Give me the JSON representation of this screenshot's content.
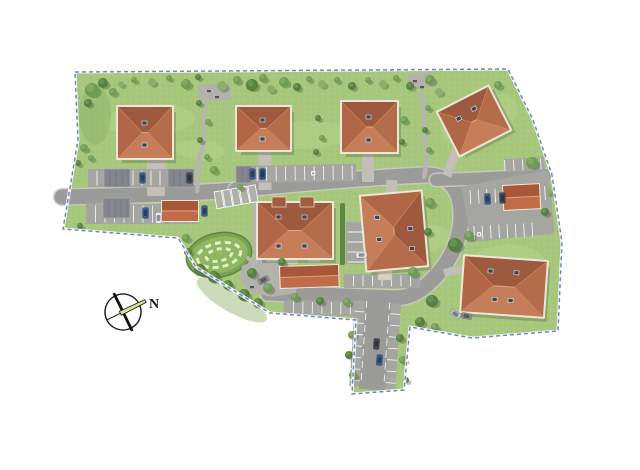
{
  "compass": {
    "label": "N"
  },
  "palette": {
    "grass": "#a7c77d",
    "grass_light": "#b8d28b",
    "grass_dark": "#8fb169",
    "road": "#9b9b99",
    "road_casing": "#cac9c4",
    "parking": "#a5a5a2",
    "footpath": "#b6b5af",
    "driveway": "#c1bfb7",
    "plaza": "#b2b1ab",
    "roof_north": "#9d5a3f",
    "roof_south": "#c57e59",
    "roof_west": "#b06647",
    "roof_east": "#b56c4b",
    "roof_ridge": "#dfa57f",
    "roof_hip": "#cc8a62",
    "wall": "#ece7d9",
    "terrace": "#d6d1c3",
    "carport_red_dark": "#a85839",
    "carport_red_light": "#c16c49",
    "carport_gray": "#83878d",
    "carport_gray_line": "#6e7278",
    "hedge": "#5d8544",
    "boundary": "#6f86c4",
    "marking": "#f2f2ef",
    "needle": "#d2e391",
    "tree_tones": [
      "#8ab06a",
      "#6f9c55",
      "#577f41",
      "#9ab873"
    ],
    "tree_shadow": "rgba(58,76,40,0.32)",
    "car_colors": {
      "blue": "#3d5c8f",
      "blue2": "#2f4f84",
      "dark": "#45494f",
      "white": "#e9e9e7",
      "gray": "#8a8d90",
      "silver": "#c0c2c4"
    }
  },
  "scene": {
    "site_outline": "75,72 508,69 533,120 552,175 562,242 558,331 472,338 410,327 404,390 352,394 356,320 270,313 196,267 178,238 63,229 78,140",
    "grass_patches": [
      [
        150,
        120,
        45,
        16,
        -3,
        "l"
      ],
      [
        300,
        135,
        55,
        14,
        -2,
        "l"
      ],
      [
        480,
        120,
        40,
        22,
        -25,
        "l"
      ],
      [
        505,
        265,
        40,
        20,
        -5,
        "l"
      ],
      [
        200,
        150,
        25,
        10,
        5,
        "l"
      ],
      [
        420,
        240,
        30,
        14,
        -10,
        "l"
      ],
      [
        120,
        212,
        30,
        10,
        0,
        "d"
      ],
      [
        232,
        300,
        40,
        12,
        30,
        "d"
      ],
      [
        95,
        115,
        16,
        30,
        0,
        "d"
      ],
      [
        530,
        300,
        20,
        10,
        0,
        "l"
      ]
    ],
    "roads": [
      {
        "d": "M62,197 C120,196 180,194 236,190",
        "w": 15,
        "c": 18
      },
      {
        "d": "M236,190 C300,183 380,177 424,175 C448,174 460,188 461,212 C462,238 450,264 428,284 C417,294 405,298 394,298 L268,293",
        "w": 15,
        "c": 18
      },
      {
        "d": "M436,180 C470,179 510,177 546,175",
        "w": 12,
        "c": 15
      }
    ],
    "junction_patch": [
      358,
      289,
      44,
      16,
      2
    ],
    "driveways": [
      {
        "d": "M156,160 L156,196",
        "w": 18
      },
      {
        "d": "M265,152 L265,190",
        "w": 13
      },
      {
        "d": "M368,154 L368,182",
        "w": 12
      },
      {
        "d": "M456,151 L447,176",
        "w": 9
      },
      {
        "d": "M392,180 L391,200",
        "w": 11
      },
      {
        "d": "M444,273 C452,271 458,269 467,269",
        "w": 8
      }
    ],
    "footpaths": [
      {
        "d": "M206,104 C200,120 208,136 201,152 C197,166 199,178 197,191",
        "w": 4.5
      },
      {
        "d": "M420,92 C427,110 423,130 426,148 C428,160 425,170 424,177",
        "w": 4.5
      },
      {
        "d": "M254,196 L256,262",
        "w": 4
      },
      {
        "d": "M248,258 C256,264 254,274 260,281",
        "w": 4
      }
    ],
    "plaza_rects": [
      [
        198,
        85,
        32,
        17,
        -4
      ],
      [
        407,
        75,
        26,
        15,
        -8
      ]
    ],
    "plaza_poly": "242,266 262,257 284,261 298,276 296,293 272,297 250,292 240,280",
    "parking_strips": [
      [
        88,
        169,
        106,
        18,
        0,
        9
      ],
      [
        238,
        166,
        118,
        17,
        -1,
        9.5
      ],
      [
        86,
        204,
        112,
        20,
        0,
        9.5
      ],
      [
        344,
        274,
        76,
        14,
        0,
        9.5
      ],
      [
        284,
        300,
        88,
        15,
        1,
        9.5
      ]
    ],
    "parking_strips_h": [
      [
        346,
        222,
        22,
        42,
        0,
        10
      ]
    ],
    "hatched_bays": {
      "x": 214,
      "y": 192,
      "rot": -10,
      "count": 5,
      "w": 7.4,
      "h": 17,
      "gap": 8.6
    },
    "corridor": {
      "rot": [
        4,
        380,
        305
      ],
      "bays": [
        [
          355,
          302,
          10,
          86
        ],
        [
          391,
          302,
          10,
          86
        ]
      ],
      "road": [
        365,
        298,
        26,
        92
      ],
      "lines": [
        366.5,
        389.5
      ],
      "div_y0": 313,
      "div_y1": 384,
      "div_step": 11.5
    },
    "lot": {
      "rot": [
        -3,
        470,
        190
      ],
      "body": "462,186 550,174 552,238 468,242",
      "top_row": [
        506,
        161,
        40,
        13
      ],
      "row1": {
        "x0": 470,
        "y": 190,
        "len": 14,
        "step": 8.3,
        "count": 10
      },
      "row2": {
        "x0": 472,
        "y": 226,
        "len": 14,
        "step": 8.3,
        "count": 8
      }
    },
    "garden": {
      "cx": 219,
      "cy": 255,
      "rx": 33,
      "ry": 22,
      "rot": -12
    },
    "hedges": [
      [
        340,
        203,
        5,
        62
      ]
    ],
    "terraces": [
      [
        266,
        254,
        12,
        8
      ],
      [
        286,
        256,
        12,
        8
      ],
      [
        308,
        254,
        12,
        8
      ],
      [
        378,
        268,
        14,
        12
      ],
      [
        474,
        306,
        14,
        8
      ]
    ],
    "houses": [
      {
        "x": 118,
        "y": 107,
        "w": 54,
        "h": 51,
        "rot": 0,
        "ridge": "h",
        "win": [
          [
            24,
            14
          ],
          [
            24,
            36
          ]
        ]
      },
      {
        "x": 237,
        "y": 107,
        "w": 53,
        "h": 43,
        "rot": 0,
        "ridge": "h",
        "win": [
          [
            23,
            11
          ],
          [
            23,
            30
          ]
        ]
      },
      {
        "x": 342,
        "y": 102,
        "w": 55,
        "h": 50,
        "rot": 0,
        "ridge": "h",
        "win": [
          [
            24,
            13
          ],
          [
            24,
            36
          ]
        ]
      },
      {
        "x": 446,
        "y": 97,
        "w": 56,
        "h": 48,
        "rot": -27,
        "ridge": "h",
        "win": [
          [
            13,
            13
          ],
          [
            31,
            11
          ]
        ]
      },
      {
        "x": 258,
        "y": 203,
        "w": 74,
        "h": 55,
        "rot": 0,
        "ridge": "h",
        "win": [
          [
            18,
            12
          ],
          [
            44,
            12
          ],
          [
            18,
            41
          ],
          [
            44,
            41
          ]
        ],
        "wings": [
          [
            14,
            -6,
            14,
            10
          ],
          [
            42,
            -6,
            14,
            10
          ]
        ]
      },
      {
        "x": 364,
        "y": 194,
        "w": 60,
        "h": 74,
        "rot": -5,
        "ridge": "v",
        "win": [
          [
            12,
            20
          ],
          [
            12,
            42
          ],
          [
            44,
            34
          ],
          [
            44,
            54
          ]
        ]
      },
      {
        "x": 463,
        "y": 259,
        "w": 82,
        "h": 55,
        "rot": 4,
        "ridge": "h",
        "win": [
          [
            24,
            11
          ],
          [
            50,
            11
          ],
          [
            30,
            39
          ],
          [
            46,
            39
          ]
        ]
      }
    ],
    "carports_red": [
      [
        162,
        201,
        36,
        20,
        0
      ],
      [
        280,
        267,
        58,
        21,
        -2
      ],
      [
        503,
        186,
        36,
        24,
        -3
      ]
    ],
    "carports_gray": [
      [
        104,
        169,
        26,
        18,
        0
      ],
      [
        168,
        169,
        26,
        18,
        0
      ],
      [
        236,
        166,
        16,
        17,
        0
      ],
      [
        103,
        198,
        27,
        20,
        0
      ]
    ],
    "cars": [
      [
        137,
        175,
        90,
        "blue"
      ],
      [
        184,
        175,
        90,
        "dark"
      ],
      [
        247,
        171,
        90,
        "blue"
      ],
      [
        257,
        171,
        90,
        "blue2"
      ],
      [
        140,
        210,
        90,
        "blue"
      ],
      [
        153,
        215,
        90,
        "white"
      ],
      [
        199,
        208,
        90,
        "blue"
      ],
      [
        482,
        196,
        88,
        "blue"
      ],
      [
        497,
        195,
        88,
        "dark"
      ],
      [
        356,
        252,
        0,
        "white"
      ],
      [
        258,
        277,
        -25,
        "gray"
      ],
      [
        371,
        341,
        94,
        "dark"
      ],
      [
        374,
        357,
        94,
        "blue"
      ],
      [
        461,
        313,
        10,
        "gray"
      ],
      [
        450,
        311,
        35,
        "silver"
      ]
    ],
    "trees": [
      [
        92,
        90,
        7,
        1
      ],
      [
        103,
        83,
        5,
        2
      ],
      [
        113,
        92,
        4,
        1
      ],
      [
        88,
        103,
        4,
        2
      ],
      [
        121,
        84,
        3,
        0
      ],
      [
        134,
        80,
        3,
        1
      ],
      [
        152,
        82,
        4,
        0
      ],
      [
        169,
        78,
        3,
        1
      ],
      [
        186,
        84,
        5,
        1
      ],
      [
        198,
        77,
        3,
        2
      ],
      [
        222,
        86,
        5,
        0
      ],
      [
        237,
        80,
        4,
        1
      ],
      [
        252,
        85,
        6,
        2
      ],
      [
        263,
        78,
        4,
        1
      ],
      [
        271,
        89,
        4,
        0
      ],
      [
        284,
        82,
        5,
        1
      ],
      [
        297,
        87,
        4,
        2
      ],
      [
        309,
        79,
        3,
        1
      ],
      [
        322,
        84,
        4,
        0
      ],
      [
        337,
        80,
        3,
        1
      ],
      [
        352,
        86,
        4,
        2
      ],
      [
        368,
        80,
        3,
        1
      ],
      [
        383,
        84,
        4,
        0
      ],
      [
        396,
        78,
        3,
        1
      ],
      [
        410,
        86,
        4,
        2
      ],
      [
        430,
        80,
        5,
        1
      ],
      [
        439,
        92,
        4,
        0
      ],
      [
        498,
        85,
        4,
        1
      ],
      [
        199,
        103,
        3,
        2
      ],
      [
        208,
        122,
        3,
        1
      ],
      [
        200,
        140,
        3,
        2
      ],
      [
        207,
        157,
        3,
        1
      ],
      [
        214,
        170,
        4,
        1
      ],
      [
        318,
        118,
        3,
        2
      ],
      [
        322,
        138,
        3,
        1
      ],
      [
        316,
        152,
        3,
        2
      ],
      [
        404,
        120,
        4,
        1
      ],
      [
        402,
        142,
        3,
        2
      ],
      [
        428,
        108,
        3,
        1
      ],
      [
        425,
        130,
        3,
        2
      ],
      [
        429,
        150,
        3,
        1
      ],
      [
        532,
        163,
        6,
        1
      ],
      [
        549,
        192,
        3,
        0
      ],
      [
        545,
        212,
        4,
        2
      ],
      [
        455,
        245,
        7,
        2
      ],
      [
        469,
        236,
        5,
        1
      ],
      [
        430,
        203,
        5,
        1
      ],
      [
        428,
        232,
        4,
        2
      ],
      [
        84,
        148,
        4,
        1
      ],
      [
        78,
        163,
        3,
        2
      ],
      [
        91,
        158,
        3,
        1
      ],
      [
        80,
        226,
        3,
        2
      ],
      [
        186,
        238,
        4,
        1
      ],
      [
        188,
        252,
        4,
        2
      ],
      [
        200,
        270,
        6,
        2
      ],
      [
        214,
        277,
        6,
        2
      ],
      [
        228,
        285,
        5,
        2
      ],
      [
        244,
        295,
        6,
        2
      ],
      [
        258,
        303,
        5,
        2
      ],
      [
        252,
        273,
        5,
        2
      ],
      [
        268,
        288,
        5,
        1
      ],
      [
        282,
        262,
        4,
        2
      ],
      [
        295,
        297,
        4,
        1
      ],
      [
        320,
        301,
        4,
        2
      ],
      [
        347,
        302,
        4,
        1
      ],
      [
        352,
        335,
        4,
        1
      ],
      [
        349,
        355,
        4,
        2
      ],
      [
        353,
        375,
        4,
        1
      ],
      [
        400,
        338,
        4,
        2
      ],
      [
        403,
        360,
        4,
        1
      ],
      [
        406,
        380,
        3,
        2
      ],
      [
        413,
        272,
        5,
        1
      ],
      [
        432,
        301,
        6,
        2
      ],
      [
        420,
        322,
        5,
        2
      ],
      [
        435,
        327,
        4,
        1
      ],
      [
        240,
        187,
        3,
        1
      ]
    ],
    "benches": [
      [
        207,
        90
      ],
      [
        215,
        96
      ],
      [
        413,
        80
      ],
      [
        420,
        86
      ],
      [
        262,
        281
      ],
      [
        250,
        286
      ]
    ],
    "disabled_icons": [
      [
        311,
        171
      ],
      [
        477,
        232
      ]
    ],
    "compass_geo": {
      "cx": 123,
      "cy": 312,
      "r": 18,
      "rot": -26
    }
  }
}
